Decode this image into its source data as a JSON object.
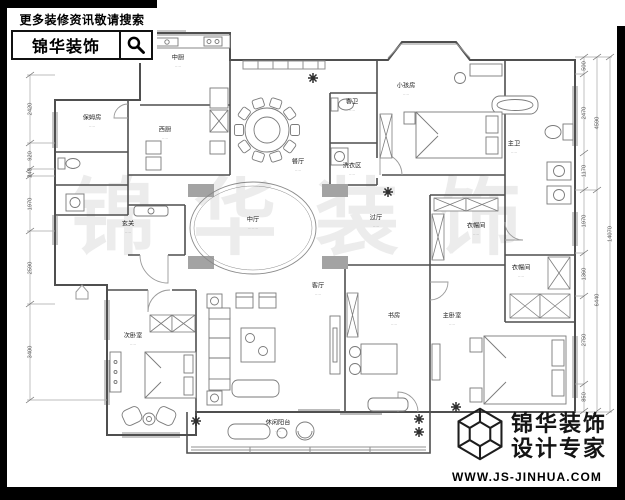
{
  "header": {
    "search_hint": "更多装修资讯敬请搜索",
    "brand": "锦华装饰"
  },
  "footer": {
    "brand_line1": "锦华装饰",
    "brand_line2": "设计专家",
    "website": "WWW.JS-JINHUA.COM"
  },
  "watermark": "锦华装饰",
  "plan": {
    "rooms": [
      {
        "id": "zhongchu",
        "label": "中厨",
        "note": "·····",
        "x": 178,
        "y": 62
      },
      {
        "id": "xichu",
        "label": "西厨",
        "note": "·····",
        "x": 165,
        "y": 134
      },
      {
        "id": "baomufang",
        "label": "保姆房",
        "note": "·····",
        "x": 92,
        "y": 122
      },
      {
        "id": "canting",
        "label": "餐厅",
        "note": "·····",
        "x": 298,
        "y": 166
      },
      {
        "id": "xuanguan",
        "label": "玄关",
        "note": "·····",
        "x": 128,
        "y": 228
      },
      {
        "id": "zhongting",
        "label": "中厅",
        "note": "········",
        "x": 253,
        "y": 224
      },
      {
        "id": "xiaohaifang",
        "label": "小孩房",
        "note": "·····",
        "x": 406,
        "y": 90
      },
      {
        "id": "kewei",
        "label": "客卫",
        "note": "·····",
        "x": 352,
        "y": 106
      },
      {
        "id": "xiyiqu",
        "label": "洗衣区",
        "note": "·····",
        "x": 352,
        "y": 170
      },
      {
        "id": "zhuwei",
        "label": "主卫",
        "note": "·····",
        "x": 514,
        "y": 148
      },
      {
        "id": "yimaojian-1",
        "label": "衣帽间",
        "note": "·····",
        "x": 476,
        "y": 230
      },
      {
        "id": "yimaojian-2",
        "label": "衣帽间",
        "note": "·····",
        "x": 521,
        "y": 272
      },
      {
        "id": "guoting",
        "label": "过厅",
        "note": "·····",
        "x": 376,
        "y": 222
      },
      {
        "id": "keting",
        "label": "客厅",
        "note": "·····",
        "x": 318,
        "y": 290
      },
      {
        "id": "shufang",
        "label": "书房",
        "note": "·····",
        "x": 394,
        "y": 320
      },
      {
        "id": "zhuwoshi",
        "label": "主卧室",
        "note": "·····",
        "x": 452,
        "y": 320
      },
      {
        "id": "ciwoshi",
        "label": "次卧室",
        "note": "·····",
        "x": 133,
        "y": 340
      },
      {
        "id": "yangtai",
        "label": "休闲阳台",
        "note": "·····",
        "x": 278,
        "y": 427
      }
    ],
    "dims": {
      "left": [
        {
          "v": "2420",
          "x": 30,
          "y": 109
        },
        {
          "v": "920",
          "x": 30,
          "y": 156
        },
        {
          "v": "240",
          "x": 30,
          "y": 173
        },
        {
          "v": "1970",
          "x": 30,
          "y": 204
        },
        {
          "v": "2590",
          "x": 30,
          "y": 268
        },
        {
          "v": "3400",
          "x": 30,
          "y": 352
        }
      ],
      "right_inner": [
        {
          "v": "500",
          "x": 584,
          "y": 66
        },
        {
          "v": "2470",
          "x": 584,
          "y": 113
        },
        {
          "v": "1170",
          "x": 584,
          "y": 171
        },
        {
          "v": "1970",
          "x": 584,
          "y": 221
        },
        {
          "v": "1360",
          "x": 584,
          "y": 274
        },
        {
          "v": "2750",
          "x": 584,
          "y": 340
        },
        {
          "v": "850",
          "x": 584,
          "y": 397
        }
      ],
      "right_mid": [
        {
          "v": "4590",
          "x": 597,
          "y": 123
        },
        {
          "v": "6440",
          "x": 597,
          "y": 300
        }
      ],
      "right_outer": [
        {
          "v": "14070",
          "x": 610,
          "y": 234
        }
      ]
    }
  }
}
